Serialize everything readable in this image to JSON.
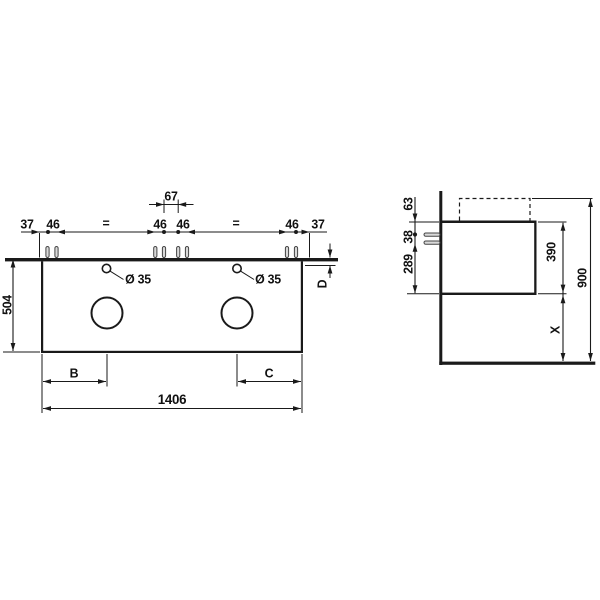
{
  "front_view": {
    "top_chain": {
      "d37_left": "37",
      "d46_pair1": "46",
      "eq_left": "=",
      "d46_pair2": "46",
      "d67_center": "67",
      "d46_pair3": "46",
      "eq_right": "=",
      "d46_pair4": "46",
      "d37_right": "37"
    },
    "d504": "504",
    "faucet_left": "Ø 35",
    "faucet_right": "Ø 35",
    "dB": "B",
    "dC": "C",
    "d1406": "1406",
    "dD": "D"
  },
  "side_view": {
    "d63": "63",
    "d38": "38",
    "d289": "289",
    "d390": "390",
    "d900": "900",
    "dX": "X"
  },
  "colors": {
    "line": "#1a1a1a",
    "background": "#ffffff"
  }
}
